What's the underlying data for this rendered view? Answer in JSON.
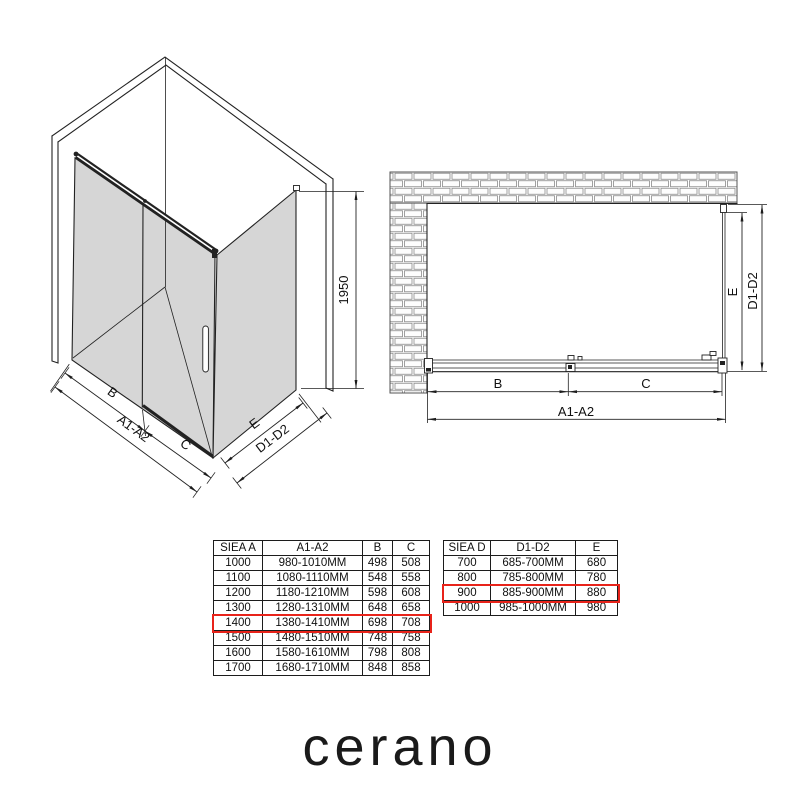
{
  "labels": {
    "b": "B",
    "c": "C",
    "a1a2": "A1-A2",
    "e": "E",
    "d1d2": "D1-D2",
    "height": "1950"
  },
  "size_tables": [
    {
      "name": "width-table",
      "headers": [
        "SIEA A",
        "A1-A2",
        "B",
        "C"
      ],
      "rows": [
        [
          "1000",
          "980-1010MM",
          "498",
          "508"
        ],
        [
          "1100",
          "1080-1110MM",
          "548",
          "558"
        ],
        [
          "1200",
          "1180-1210MM",
          "598",
          "608"
        ],
        [
          "1300",
          "1280-1310MM",
          "648",
          "658"
        ],
        [
          "1400",
          "1380-1410MM",
          "698",
          "708"
        ],
        [
          "1500",
          "1480-1510MM",
          "748",
          "758"
        ],
        [
          "1600",
          "1580-1610MM",
          "798",
          "808"
        ],
        [
          "1700",
          "1680-1710MM",
          "848",
          "858"
        ]
      ],
      "highlight_row": 4
    },
    {
      "name": "depth-table",
      "headers": [
        "SIEA D",
        "D1-D2",
        "E"
      ],
      "rows": [
        [
          "700",
          "685-700MM",
          "680"
        ],
        [
          "800",
          "785-800MM",
          "780"
        ],
        [
          "900",
          "885-900MM",
          "880"
        ],
        [
          "1000",
          "985-1000MM",
          "980"
        ]
      ],
      "highlight_row": 2
    }
  ],
  "brand": {
    "logo": "cerano"
  },
  "colors": {
    "highlight": "#e8231a",
    "glass": "#d6d6d6",
    "line": "#222222"
  }
}
